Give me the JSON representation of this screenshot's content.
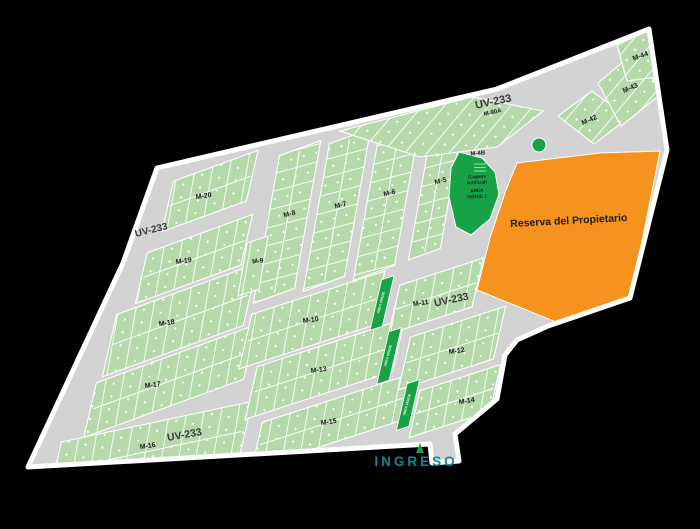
{
  "map": {
    "colors": {
      "background": "#000000",
      "road": "#d3d3d3",
      "boundary": "#ffffff",
      "block_green": "#b5d9ab",
      "lot_line": "#ffffff",
      "dark_green": "#17a345",
      "orange": "#f6921e",
      "label_text": "#1c1c1c",
      "uv_text": "#3a3a3a",
      "ingreso_text": "#12879b"
    },
    "uv_label": "UV-233",
    "m90a_label": "M-90A",
    "reserva_label": "Reserva del Propietario",
    "ingreso_label": "INGRESO",
    "area_verde_strip_label": "AREA VERDE",
    "m4b": {
      "name": "M-4B",
      "laguna_line1": "(Laguna",
      "laguna_line2": "Artificial)",
      "verde_line1": "AREA",
      "verde_line2": "VERDE 1"
    },
    "blocks": {
      "m5": "M-5",
      "m6": "M-6",
      "m7": "M-7",
      "m8": "M-8",
      "m9": "M-9",
      "m10": "M-10",
      "m11": "M-11",
      "m12": "M-12",
      "m13": "M-13",
      "m14": "M-14",
      "m15": "M-15",
      "m16": "M-16",
      "m17": "M-17",
      "m18": "M-18",
      "m19": "M-19",
      "m20": "M-20",
      "m42": "M-42",
      "m43": "M-43",
      "m44": "M-44"
    }
  }
}
